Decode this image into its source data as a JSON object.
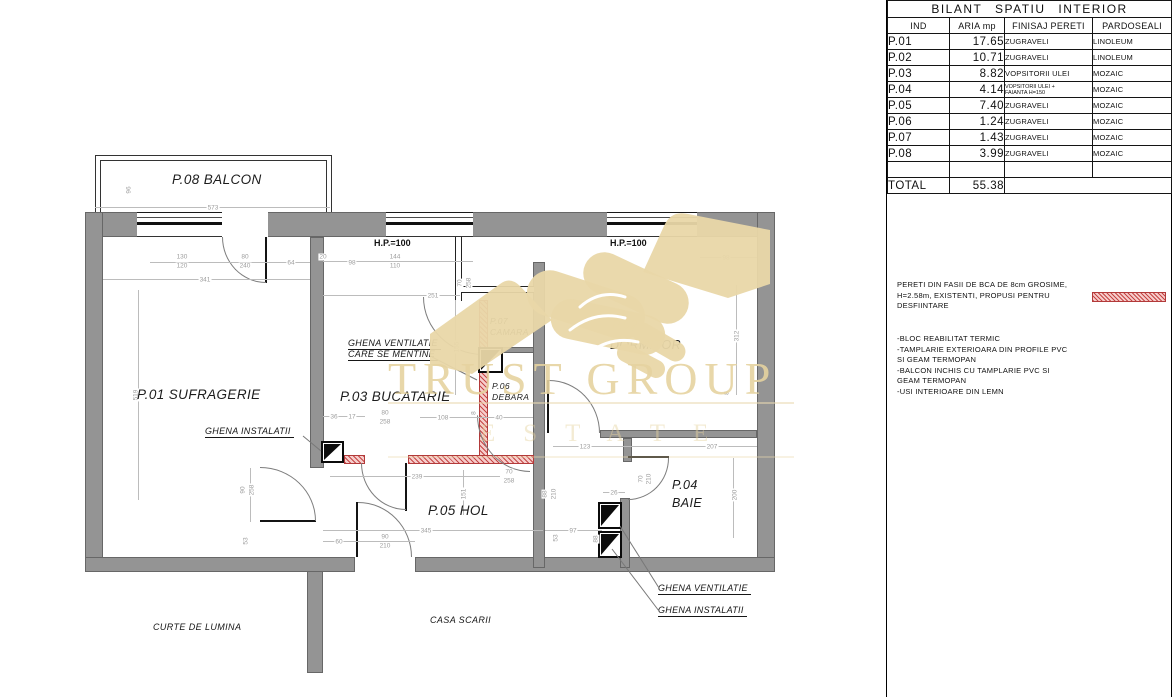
{
  "title_block": {
    "table": {
      "title": "BILANT SPATIU INTERIOR",
      "headers": [
        "IND",
        "ARIA mp",
        "FINISAJ PERETI",
        "PARDOSEALI"
      ],
      "rows": [
        {
          "ind": "P.01",
          "aria": "17.65",
          "fin": "ZUGRAVELI",
          "par": "LINOLEUM"
        },
        {
          "ind": "P.02",
          "aria": "10.71",
          "fin": "ZUGRAVELI",
          "par": "LINOLEUM"
        },
        {
          "ind": "P.03",
          "aria": "8.82",
          "fin": "VOPSITORII ULEI",
          "par": "MOZAIC"
        },
        {
          "ind": "P.04",
          "aria": "4.14",
          "fin1": "VOPSITORII ULEI +",
          "fin2": "FAIANTA H=150",
          "par": "MOZAIC"
        },
        {
          "ind": "P.05",
          "aria": "7.40",
          "fin": "ZUGRAVELI",
          "par": "MOZAIC"
        },
        {
          "ind": "P.06",
          "aria": "1.24",
          "fin": "ZUGRAVELI",
          "par": "MOZAIC"
        },
        {
          "ind": "P.07",
          "aria": "1.43",
          "fin": "ZUGRAVELI",
          "par": "MOZAIC"
        },
        {
          "ind": "P.08",
          "aria": "3.99",
          "fin": "ZUGRAVELI",
          "par": "MOZAIC"
        }
      ],
      "total_label": "TOTAL",
      "total_value": "55.38"
    },
    "notes": {
      "demolition": [
        "PERETI DIN FASII DE BCA DE 8cm GROSIME,",
        "H=2.58m, EXISTENTI, PROPUSI PENTRU",
        "DESFIINTARE"
      ],
      "bullets": [
        "-BLOC REABILITAT TERMIC",
        "-TAMPLARIE EXTERIOARA DIN PROFILE PVC",
        "SI GEAM TERMOPAN",
        "-BALCON INCHIS CU TAMPLARIE PVC SI",
        "GEAM TERMOPAN",
        "-USI INTERIOARE DIN LEMN"
      ]
    }
  },
  "plan": {
    "labels": {
      "balcon": "P.08 BALCON",
      "sufragerie": "P.01 SUFRAGERIE",
      "bucatarie": "P.03 BUCATARIE",
      "camara1": "P.07",
      "camara2": "CAMARA",
      "debara1": "P.06",
      "debara2": "DEBARA",
      "dormitor1": "P.02",
      "dormitor2": "DORMITOR",
      "hol": "P.05 HOL",
      "baie1": "P.04",
      "baie2": "BAIE",
      "hp_kitchen": "H.P.=100",
      "hp_dormitor": "H.P.=100",
      "ghena_vent_line1": "GHENA VENTILATIE",
      "ghena_vent_line2": "CARE SE MENTINE",
      "ghena_inst_left": "GHENA INSTALATII",
      "ghena_vent_bottom": "GHENA VENTILATIE",
      "ghena_inst_bottom": "GHENA INSTALATII",
      "curte": "CURTE DE LUMINA",
      "casa_scarii": "CASA SCARII"
    },
    "watermark": {
      "line1": "TRUST GROUP",
      "line2": "ESTATE"
    },
    "dims": [
      "573",
      "96",
      "130",
      "120",
      "80",
      "240",
      "64",
      "341",
      "20",
      "98",
      "144",
      "110",
      "251",
      "70",
      "258",
      "519",
      "98",
      "312",
      "155",
      "36",
      "17",
      "108",
      "8",
      "40",
      "80",
      "258",
      "123",
      "207",
      "239",
      "70",
      "258",
      "151",
      "345",
      "90",
      "258",
      "53",
      "60",
      "90",
      "210",
      "97",
      "53",
      "88",
      "88",
      "210",
      "26",
      "70",
      "210",
      "200",
      "8"
    ]
  },
  "colors": {
    "wall": "#949494",
    "demolition_fill": "#f6cdcb",
    "demolition_line": "#b23a3a",
    "watermark_beige": "#e6d3a0",
    "dim_text": "#9d9d9d"
  }
}
